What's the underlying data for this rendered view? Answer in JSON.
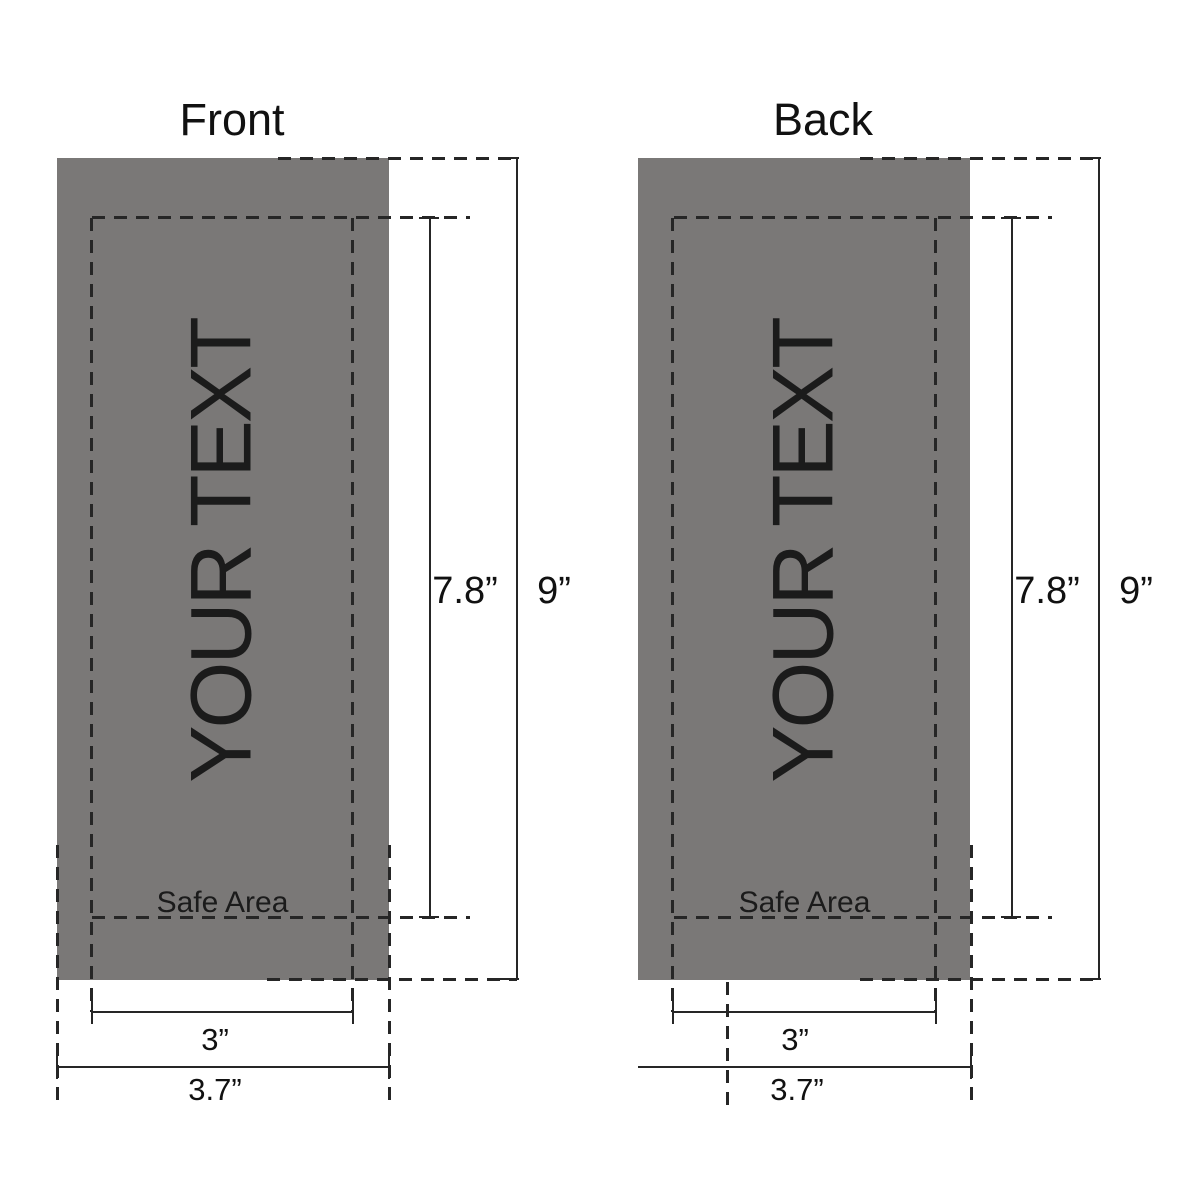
{
  "colors": {
    "panel_gray": "#7a7877",
    "line": "#262626",
    "label_text": "#111111",
    "your_text": "#1b1b1b",
    "background": "#ffffff"
  },
  "front": {
    "title": "Front",
    "placeholder_text": "YOUR TEXT",
    "safe_area_label": "Safe Area",
    "safe_height": "7.8”",
    "total_height": "9”",
    "safe_width": "3”",
    "total_width": "3.7”"
  },
  "back": {
    "title": "Back",
    "placeholder_text": "YOUR TEXT",
    "safe_area_label": "Safe Area",
    "safe_height": "7.8”",
    "total_height": "9”",
    "safe_width": "3”",
    "total_width": "3.7”"
  }
}
